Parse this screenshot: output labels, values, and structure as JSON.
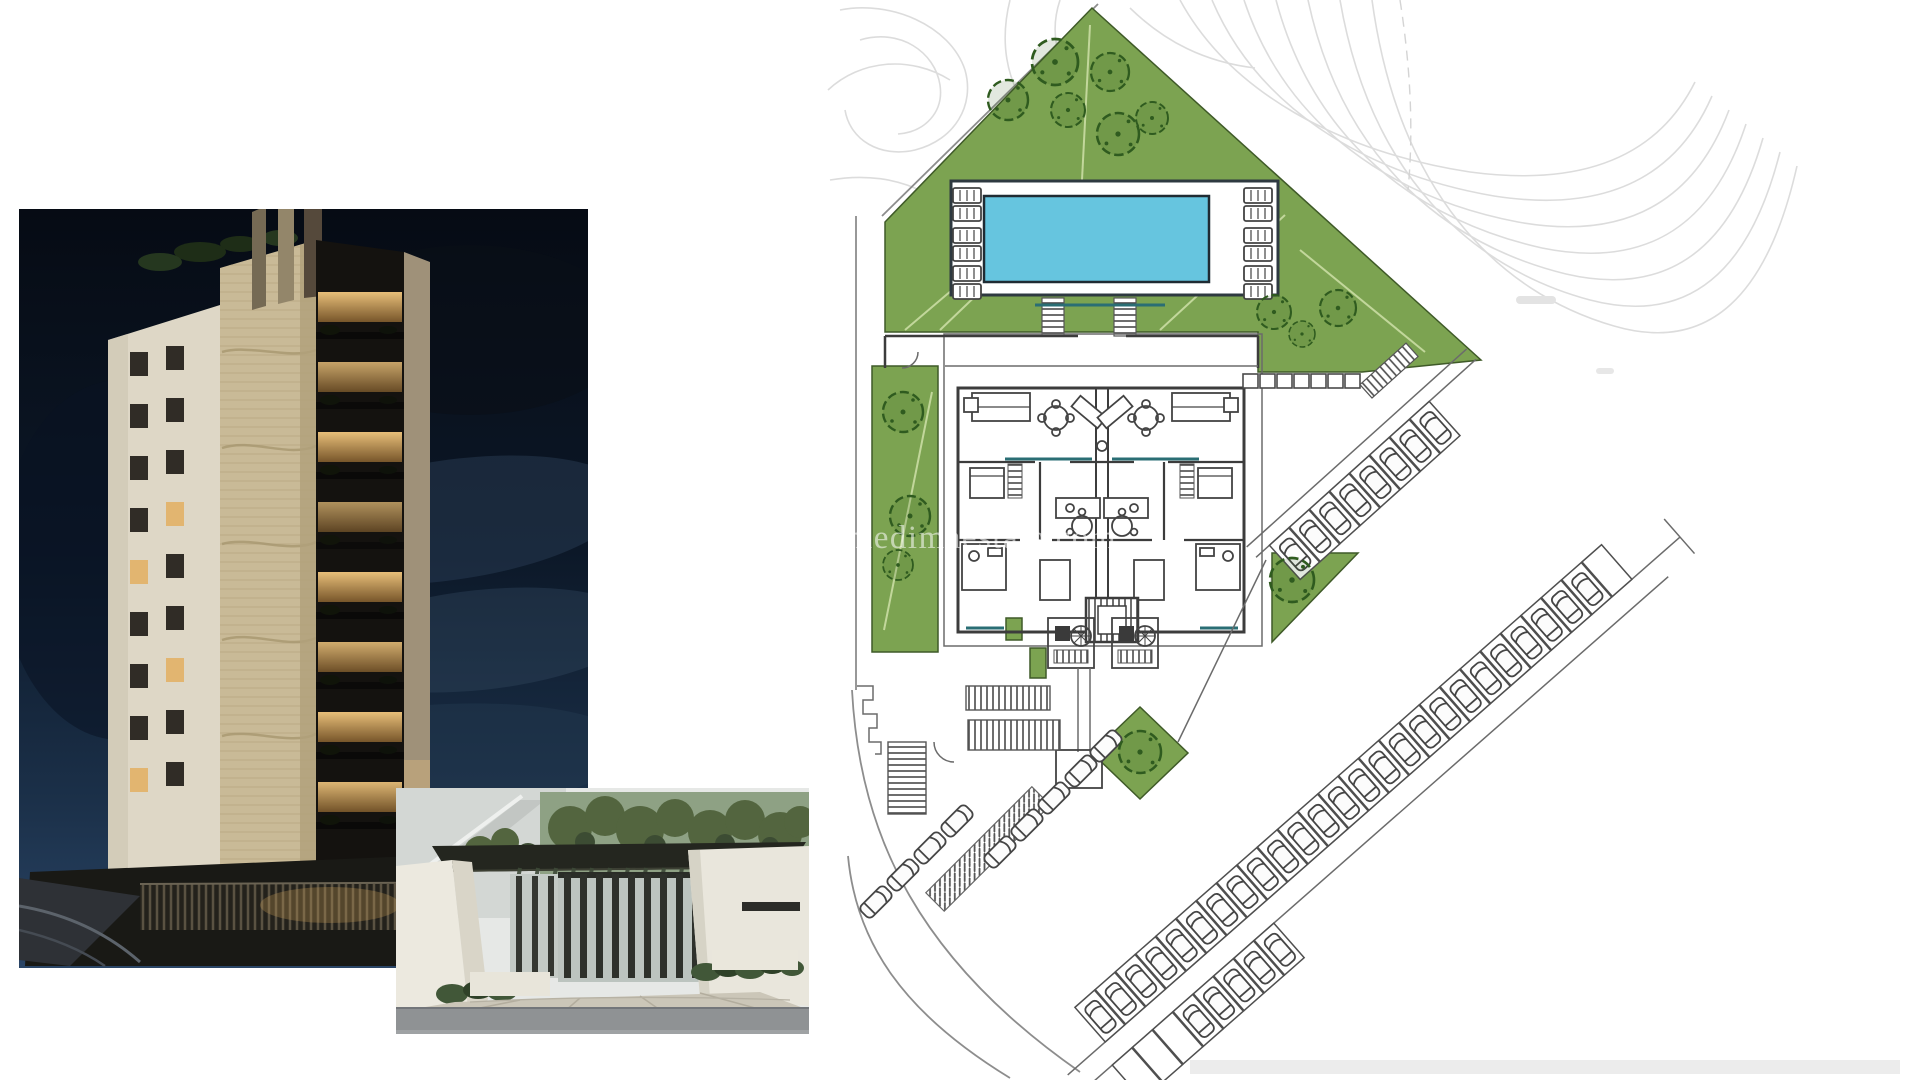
{
  "watermark": {
    "text": "www.medimaestate.com"
  },
  "panels": {
    "tower_photo_alt": "Night render of a ten-storey apartment tower with lit balconies",
    "entrance_photo_alt": "Render of a gated entrance drive with dark pergola and white walls",
    "site_plan_alt": "Site plan: pool terrace with sun loungers, twin apartment floor plan, landscaped gardens, diagonal perimeter parking and terrain contour lines"
  },
  "colors": {
    "page_background": "#ffffff",
    "plan_green": "#7ca351",
    "pool_water": "#66c5df",
    "pool_deck": "#ffffff",
    "plan_wall_dark": "#3c3c3c",
    "teal_accent": "#2a6e74",
    "contour_grey": "#dcdcdc",
    "night_sky_top": "#060b14",
    "night_sky_bottom": "#2a4566",
    "tower_facade_beige": "#c9ba97",
    "tower_slab_white": "#ded7c6",
    "window_glow_amber": "#e2b570",
    "street_grey": "#8f9294"
  }
}
